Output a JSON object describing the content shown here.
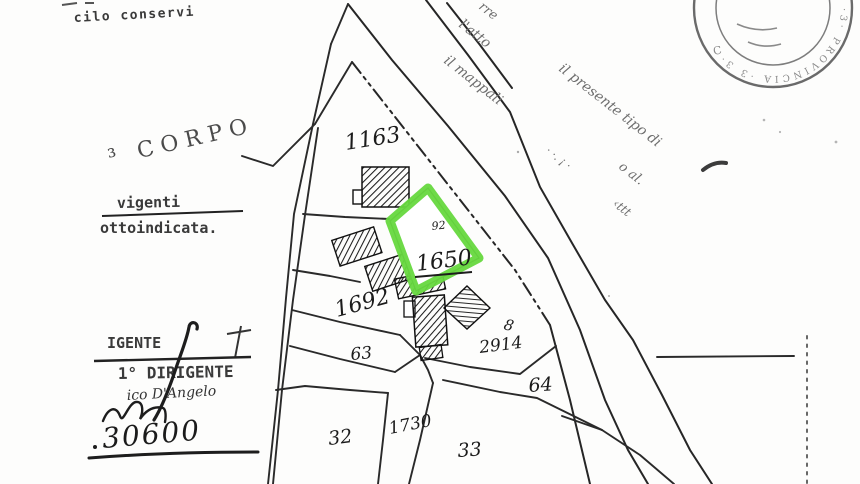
{
  "colors": {
    "highlight": "#66d83e",
    "ink": "#2a2a2a",
    "stamp_gray": "#8a8a8a"
  },
  "left_margin": {
    "top_fragment": "cilo conservi",
    "corpo_stamp": "³ CORPO",
    "vigenti": "vigenti",
    "sottoindicata": "ottoindicata.",
    "igente": "IGENTE",
    "dirigente_line": "1° DIRIGENTE",
    "signature_name": "ico D'Angelo",
    "handwritten_amount": "30600"
  },
  "diagonal_text": {
    "fragments": [
      "rre",
      "l'atto",
      "il mappali",
      "· ·. ¡ ·",
      "il presente tipo di",
      "o al.",
      "‹ttt"
    ]
  },
  "stamp": {
    "ring_text": "·3· PROVINCIA ·3 3·",
    "inner_letter": "C"
  },
  "map": {
    "highlighted_parcel": "1650",
    "highlight_color": "#66d83e",
    "parcels": [
      {
        "label": "1163"
      },
      {
        "label": "92"
      },
      {
        "label": "1650"
      },
      {
        "label": "1692"
      },
      {
        "label": "63"
      },
      {
        "label": "2914"
      },
      {
        "label": "8"
      },
      {
        "label": "64"
      },
      {
        "label": "32"
      },
      {
        "label": "1730"
      },
      {
        "label": "33"
      }
    ]
  }
}
